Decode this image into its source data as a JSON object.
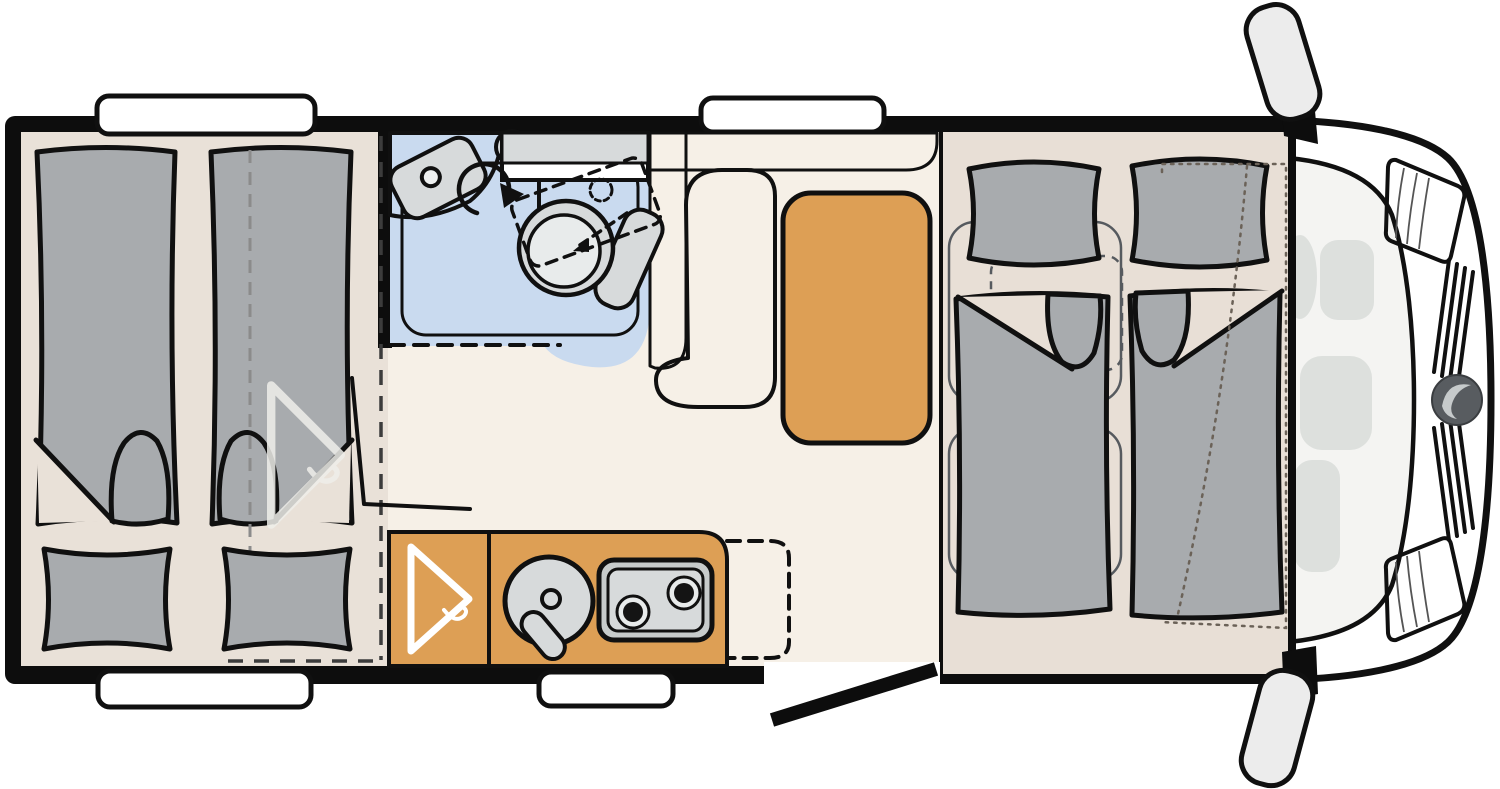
{
  "diagram": {
    "kind": "motorhome-floorplan-top-view",
    "areas": {
      "rear_bedroom": {
        "single_beds": 2,
        "pillows": 2,
        "wardrobe_hint": "ghost-hanger",
        "partition": "dashed-line",
        "split_bed_marker": "dashed-centerline"
      },
      "bathroom": {
        "fixtures": [
          "washbasin",
          "faucet-knob",
          "swivel-toilet",
          "shower-tray",
          "overhead-cabinet",
          "swivel-arrow"
        ]
      },
      "lounge": {
        "furniture": [
          "overhead-counter",
          "l-shaped-bench",
          "side-table"
        ]
      },
      "kitchen": {
        "fixtures": [
          "wardrobe-with-hanger",
          "round-sink",
          "two-burner-hob",
          "folding-worktop-extension-dashed"
        ]
      },
      "front_bed_area": {
        "single_beds": 2,
        "pillows": 2,
        "travel_seat_outlines": 2,
        "drop_down_bed_outline": "dotted"
      },
      "cab": {
        "features": [
          "windshield",
          "steering-wheel",
          "driver-seat",
          "passenger-seat",
          "headlight-left",
          "headlight-right",
          "grille",
          "brand-logo",
          "mirror-left",
          "mirror-right"
        ]
      },
      "openings": {
        "windows": 4,
        "entry_door": "open-door-bottom-right-of-kitchen"
      }
    }
  },
  "colors": {
    "outline": "#101010",
    "wall": "#0d0d0d",
    "floor_main": "#f6f0e7",
    "floor_bedroom": "#e9e1d8",
    "floor_platform": "#e8dfd6",
    "mattress": "#a8abae",
    "orange": "#dd9f55",
    "bath_floor": "#c9daef",
    "fixture_light": "#d7dadb",
    "fixture_lighter": "#e8ebeb",
    "fixture_mid": "#c7cbcb",
    "fixture_dark": "#9aa0a7",
    "bench": "#e2dad2",
    "vehicle": "#ececec",
    "vehicle_interior": "#f4f4f2",
    "ghost_seat": "#dde0dd",
    "window": "#ffffff",
    "dash": "#3c3c3c",
    "dash_light": "#8b8b8b",
    "dotted": "#6b6258",
    "seat_outline": "#565a5f",
    "ghost_hanger": "#efeeea",
    "hanger": "#ffffff",
    "burner": "#141414",
    "logo": "#585c60",
    "logo_mark": "#c6cacb"
  }
}
